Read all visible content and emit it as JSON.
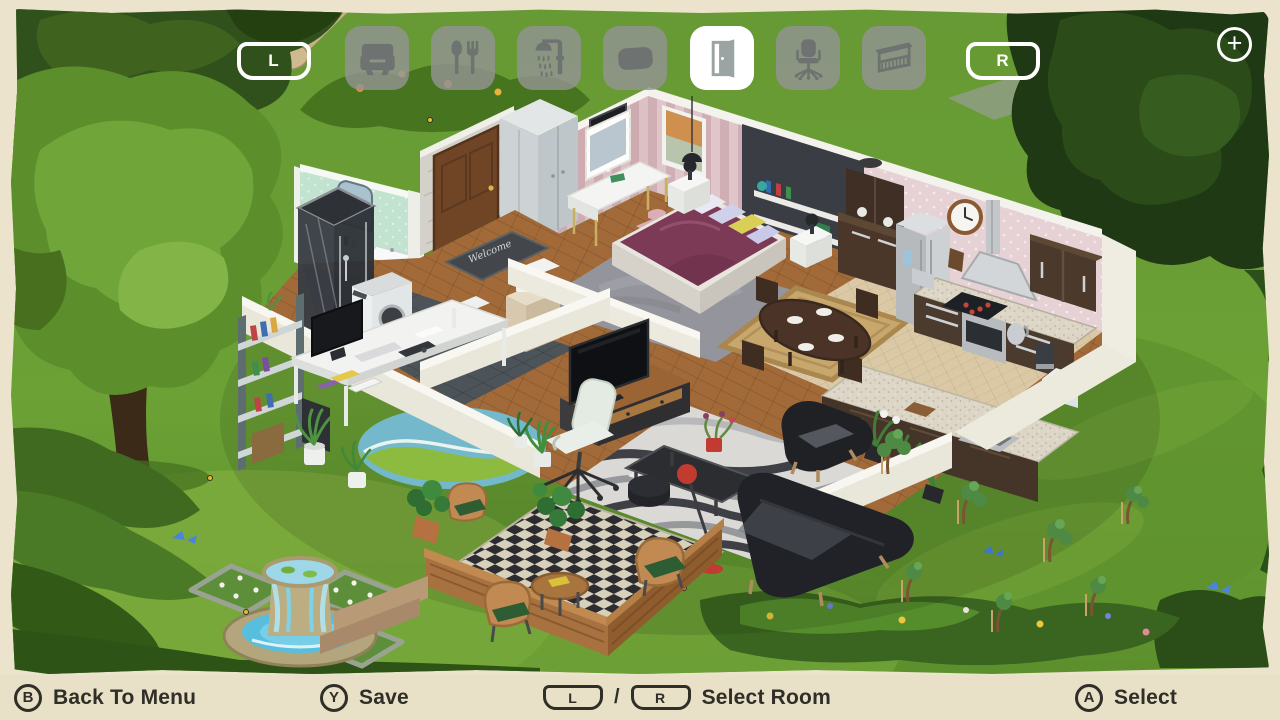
{
  "toolbar": {
    "left_shoulder": "L",
    "right_shoulder": "R",
    "plus_button": "+",
    "categories": [
      {
        "name": "living-room",
        "icon": "armchair-icon",
        "selected": false
      },
      {
        "name": "dining-kitchen",
        "icon": "cutlery-icon",
        "selected": false
      },
      {
        "name": "bathroom",
        "icon": "shower-icon",
        "selected": false
      },
      {
        "name": "bedroom",
        "icon": "pillow-icon",
        "selected": false
      },
      {
        "name": "doors-entry",
        "icon": "door-icon",
        "selected": true
      },
      {
        "name": "office",
        "icon": "office-chair-icon",
        "selected": false
      },
      {
        "name": "balcony",
        "icon": "balcony-icon",
        "selected": false
      }
    ]
  },
  "bottom_bar": {
    "back": {
      "button": "B",
      "label": "Back To Menu"
    },
    "save": {
      "button": "Y",
      "label": "Save"
    },
    "select_room": {
      "left_button": "L",
      "separator": "/",
      "right_button": "R",
      "label": "Select Room"
    },
    "select": {
      "button": "A",
      "label": "Select"
    }
  },
  "scene": {
    "doormat_text": "Welcome",
    "rooms": [
      "bathroom",
      "hallway",
      "bedroom",
      "kitchen",
      "dining-area",
      "living-room",
      "office",
      "porch",
      "garden"
    ],
    "colors": {
      "grass": "#6b9c33",
      "frame": "#ebe3cb",
      "bottom_bar": "#e8e0c7",
      "bed_blanket": "#7d3a57",
      "bathroom_wall": "#c2e3cf",
      "bedroom_wall": "#ddc0c4",
      "kitchen_wall": "#e6d2d5",
      "selected_tool_bg": "#ffffff",
      "tool_bg": "#929492"
    }
  }
}
